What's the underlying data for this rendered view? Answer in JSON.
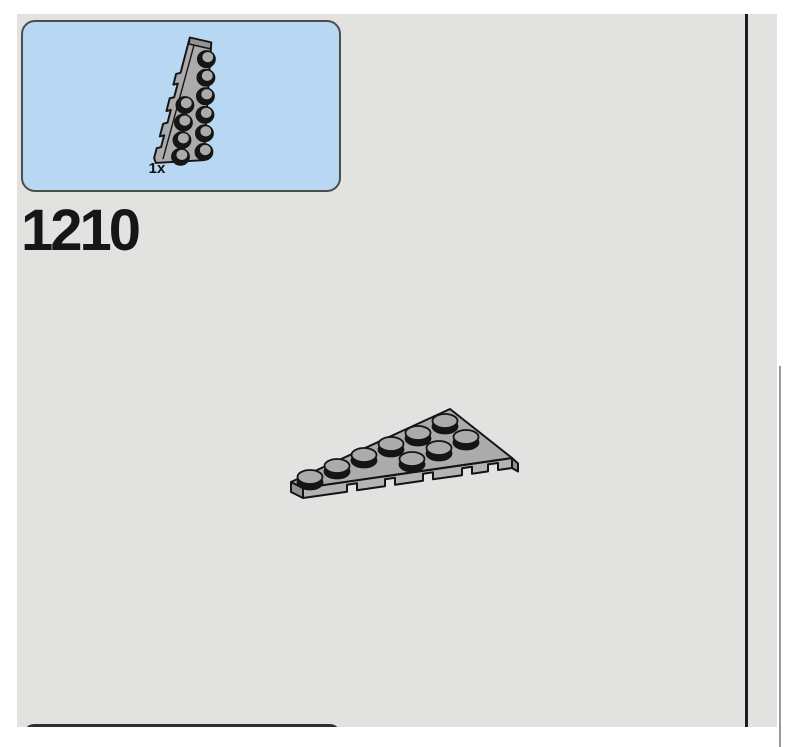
{
  "colors": {
    "surface": "#E2E2E1",
    "divider": "#1C1C1C",
    "callout-bg": "#B7D7F2",
    "callout-border": "#4D4D4D",
    "piece-top": "#ABABAB",
    "piece-front": "#B4B4B4",
    "piece-side": "#939393",
    "outline": "#141414"
  },
  "step": {
    "number": "1210"
  },
  "callout": {
    "quantity": "1x",
    "part_icon": "lego-wedge-plate-6x3-left-icon"
  },
  "main_area": {
    "part_icon": "lego-wedge-plate-6x3-left-icon"
  }
}
